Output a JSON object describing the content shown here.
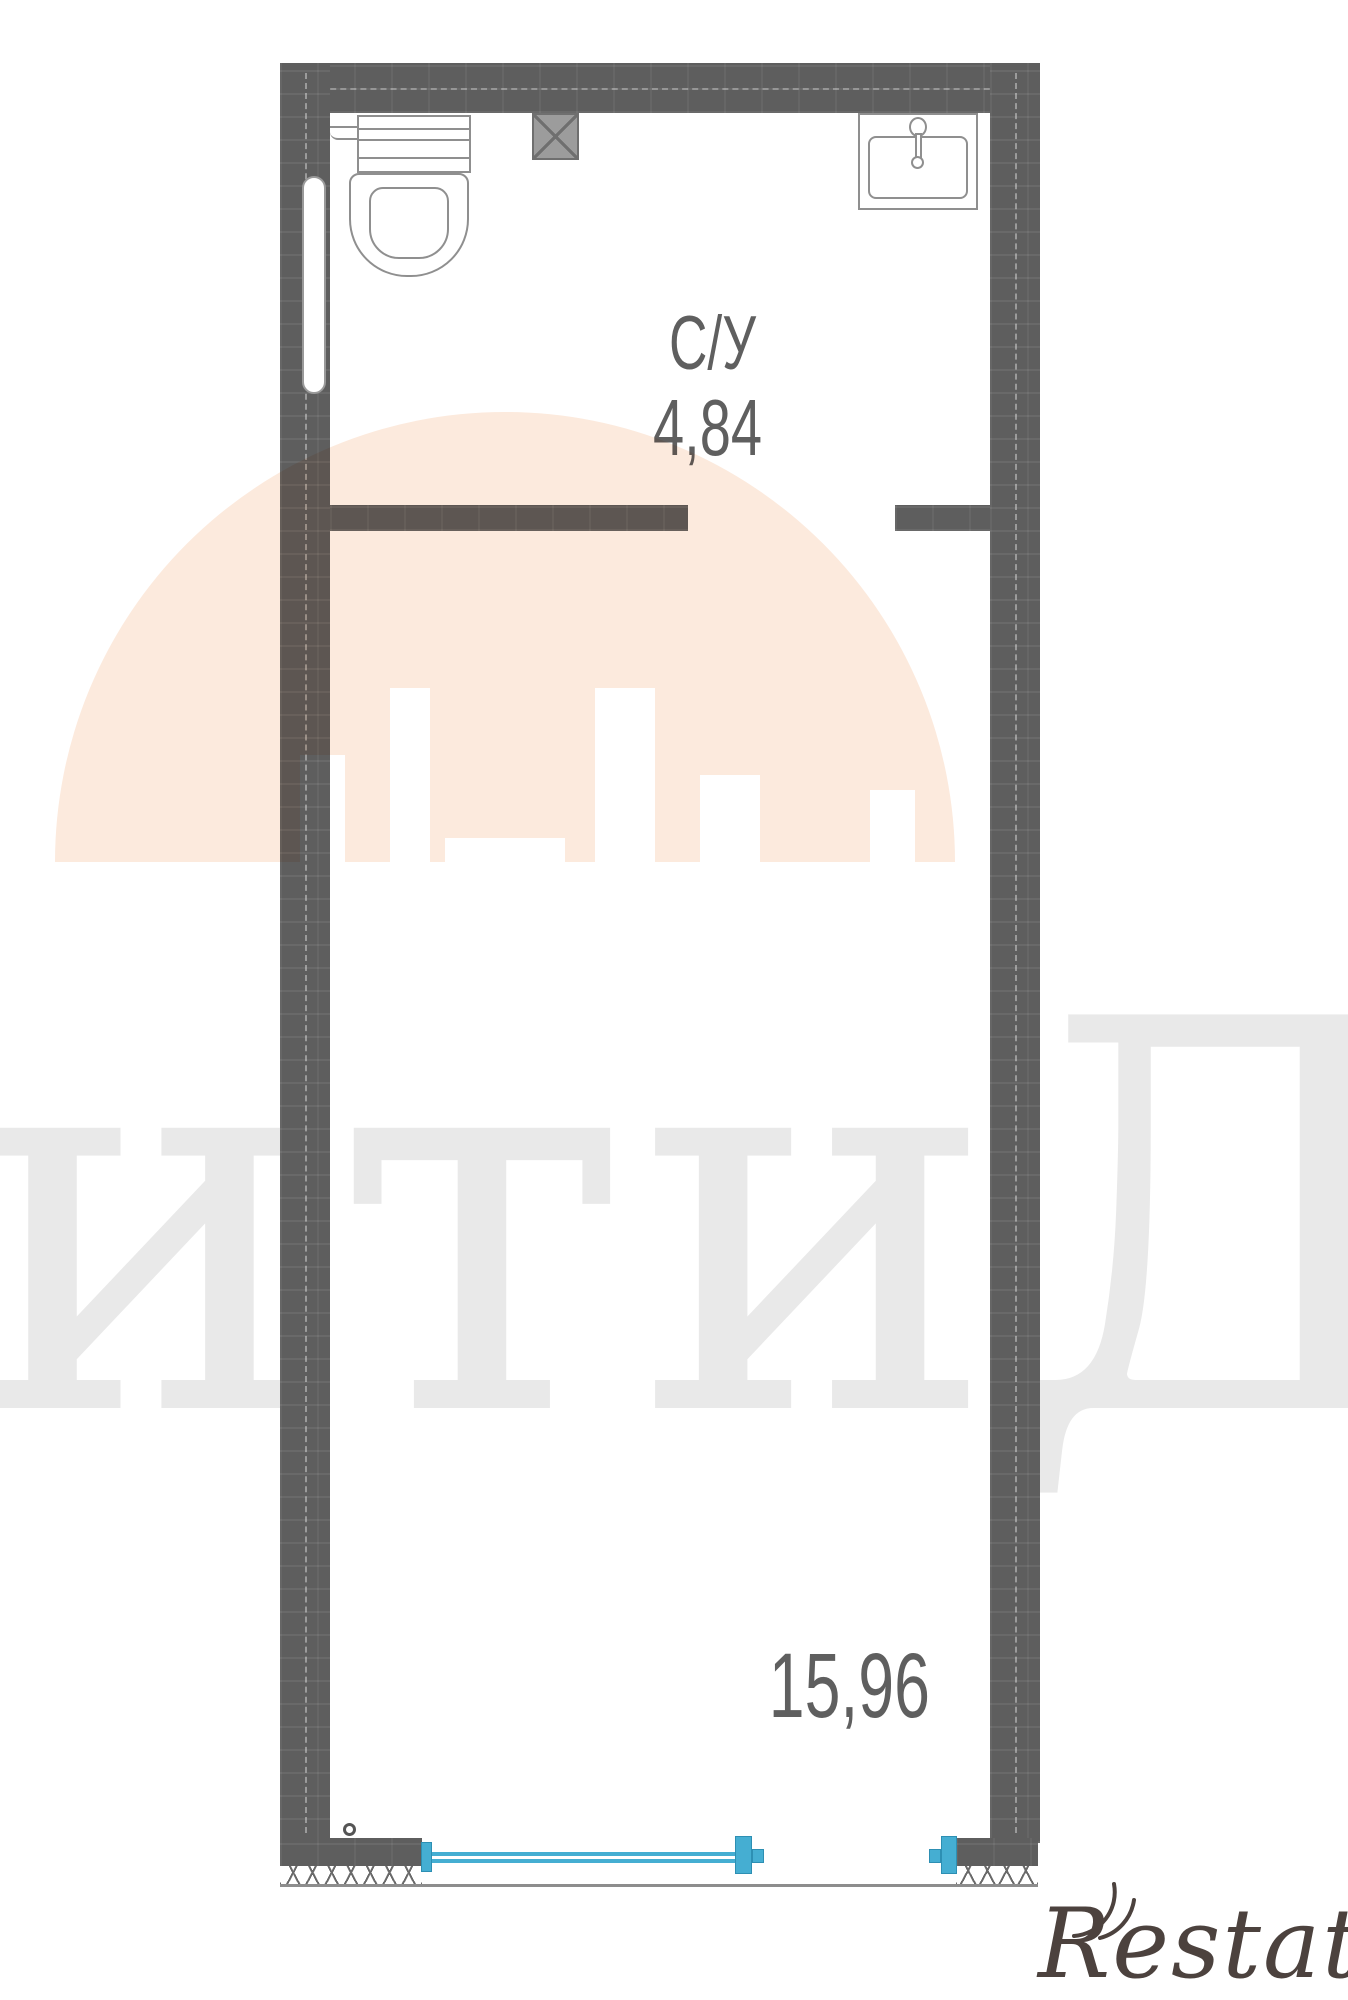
{
  "plan": {
    "rooms": [
      {
        "id": "bathroom",
        "name_label": "С/У",
        "area_label": "4,84"
      },
      {
        "id": "living",
        "name_label": "",
        "area_label": "15,96"
      }
    ],
    "fixtures": [
      "toilet",
      "sink",
      "faucet",
      "radiator",
      "vent-shaft"
    ],
    "colors": {
      "wall": "#5e5e5e",
      "fixture_outline": "#8f8f8f",
      "window": "#45aed2",
      "label_text": "#5f5f5f"
    }
  },
  "watermarks": {
    "big_text": "итиДом",
    "big_text_color": "#e9e9e9",
    "dome_color": "#fceadd",
    "logo_text": "Restate",
    "logo_color": "#4c423e"
  }
}
